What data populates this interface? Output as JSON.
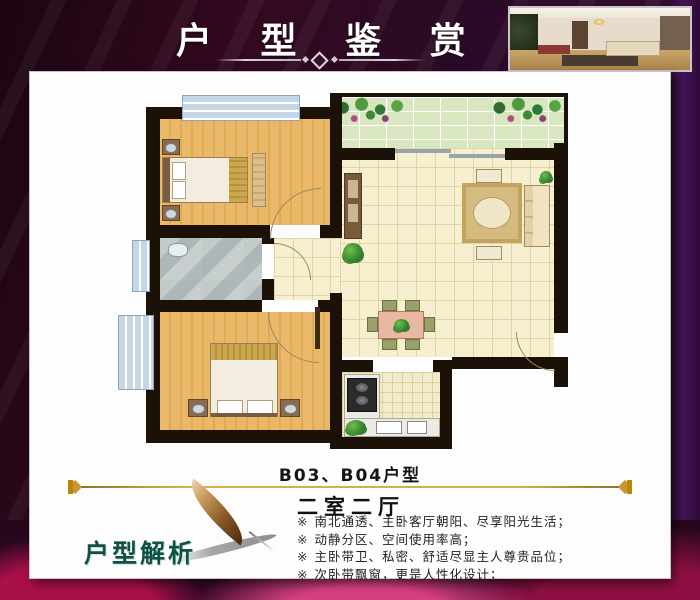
{
  "header": {
    "title": "户 型 鉴 赏"
  },
  "unit": {
    "label": "B03、B04户型",
    "type": "二室二厅"
  },
  "analysis": {
    "heading": "户型解析",
    "bullets": [
      {
        "marker": "※",
        "text": "南北通透、主卧客厅朝阳、尽享阳光生活；"
      },
      {
        "marker": "※",
        "text": "动静分区、空间使用率高；"
      },
      {
        "marker": "※",
        "text": "主卧带卫、私密、舒适尽显主人尊贵品位；"
      },
      {
        "marker": "※",
        "text": "次卧带飘窗，更是人性化设计；"
      }
    ]
  },
  "floor_plan": {
    "rooms": [
      "master-bedroom",
      "second-bedroom",
      "bathroom",
      "living-room",
      "dining-area",
      "kitchen",
      "balcony",
      "corridor"
    ],
    "features": [
      "bay-window",
      "entry-door",
      "balcony-planters"
    ]
  },
  "colors": {
    "background_purple": "#2a0820",
    "panel_white": "#fdfdfd",
    "gold_accent": "#c9a13b",
    "heading_teal": "#0f5147",
    "wall_black": "#1c1106",
    "wood_floor": "#e7b464",
    "tile_cream": "#f6efce",
    "balcony_green": "#d8e7c0",
    "marble_gray": "#bcc4c4",
    "window_blue": "#c3d7e6",
    "magenta_rose": "#c21a5e"
  }
}
